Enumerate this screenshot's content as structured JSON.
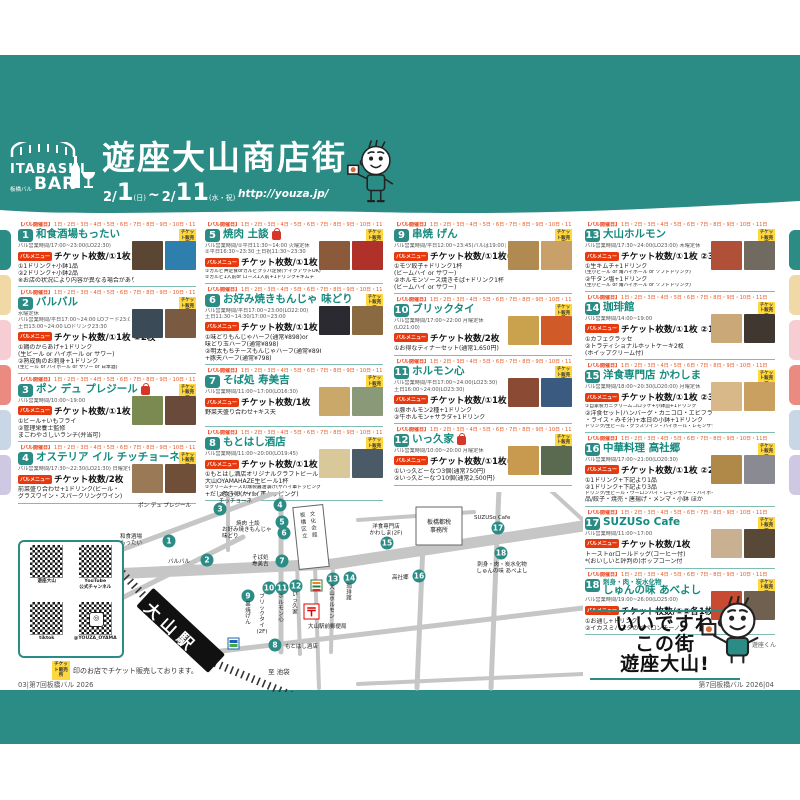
{
  "header": {
    "logo": {
      "top": "ITABASHI",
      "bottom": "BAR",
      "sub": "板橋バル"
    },
    "title": "遊座大山商店街",
    "date": {
      "m1": "2/",
      "d1": "1",
      "w1": "(日)",
      "tilde": "~",
      "m2": "2/",
      "d2": "11",
      "w2": "(水・祝)"
    },
    "url": "http://youza.jp/"
  },
  "badges": {
    "ticket_sale": "チケット販売所",
    "bar_menu": "バルメニュー",
    "open_days_prefix": "【バル開催日】",
    "open_days": "1日・2日・3日・4日・5日・6日・7日・8日・9日・10日・11日"
  },
  "entries": [
    {
      "num": "1",
      "col": 0,
      "name": "和食酒場もったい",
      "hours": [
        "バル営業時間/17:00~23:00(LO22:30)"
      ],
      "tickets": "チケット枚数/①1枚 ②2枚",
      "items": [
        "①1ドリンク+小鉢1品",
        "②2ドリンク+小鉢2品",
        "※お店の状況により内容が異なる場合があります"
      ],
      "photos": [
        "#5a4632",
        "#2f7fae"
      ]
    },
    {
      "num": "2",
      "col": 0,
      "name": "バルバル",
      "hours": [
        "水曜定休",
        "バル営業時間/平日17:00~24:00 LOフード23:00",
        "土日13:00~24:00 LOドリンク23:30"
      ],
      "tickets": "チケット枚数/①1枚 ②2枚",
      "items": [
        "①鶏のからあげ+1ドリンク",
        "(生ビール or ハイボール or サワー)",
        "②熟成魚のお刺身+1ドリンク",
        "(生ビール or ハイボール or サワー or 日本酒)"
      ],
      "photos": [
        "#3a4a56",
        "#7a5a40"
      ]
    },
    {
      "num": "3",
      "col": 0,
      "name": "ポン デュ プレジール",
      "bag": true,
      "hours": [
        "バル営業時間/10:00~19:00"
      ],
      "tickets": "チケット枚数/①1枚 ②2枚",
      "items": [
        "①ビール+いもフライ",
        "②管理栄養士監修",
        "まごわやさしいランチ(弁当可)"
      ],
      "photos": [
        "#7a8a50",
        "#6a4a3a"
      ]
    },
    {
      "num": "4",
      "col": 0,
      "name": "オステリア イル チッチョーネ",
      "hours": [
        "バル営業時間/17:30~22:30(LO21:30) 日曜定休"
      ],
      "tickets": "チケット枚数/2枚",
      "items": [
        "前菜盛り合わせ+1ドリンク(ビール・",
        "グラスワイン・スパークリングワイン)"
      ],
      "photos": [
        "#9a7a56",
        "#704f38"
      ]
    },
    {
      "num": "5",
      "col": 1,
      "name": "焼肉 土談",
      "bag": true,
      "hours": [
        "バル営業時間/①平日11:30~14:00 火曜定休",
        "②平日16:30~23:30 土日祝11:30~23:30"
      ],
      "tickets": "チケット枚数/①1枚 ②2枚",
      "items": [
        "①カルビ丼定食orカルビクッパ定食(テイクアウトOK)",
        "②カルビ1人前or ロース1人前+1ドリンク+キムチ"
      ],
      "photos": [
        "#8a5a3a",
        "#b0302a"
      ]
    },
    {
      "num": "6",
      "col": 1,
      "name": "お好み焼きもんじゃ 味どり",
      "hours": [
        "バル営業時間/平日17:00~23:00(LO22:00)",
        "土日11:30~14:30/17:00~23:00"
      ],
      "tickets": "チケット枚数/①1枚 ②2枚",
      "items": [
        "①味どりもんじゃハーフ(通常¥898)or",
        "味どり玉ハーフ(通常¥898)",
        "②明太もちチーズもんじゃハーフ(通常¥898)",
        "+豚天ハーフ(通常¥798)"
      ],
      "photos": [
        "#2a2a30",
        "#8a6a40"
      ]
    },
    {
      "num": "7",
      "col": 1,
      "name": "そば処 寿美吉",
      "hours": [
        "バル営業時間/11:00~17:00(LO16:30)"
      ],
      "tickets": "チケット枚数/1枚",
      "items": [
        "野菜天盛り合わせ+キス天"
      ],
      "photos": [
        "#caa86a",
        "#8a9a78"
      ]
    },
    {
      "num": "8",
      "col": 1,
      "name": "もとはし酒店",
      "hours": [
        "バル営業時間/11:00~20:00(LO19:45)"
      ],
      "tickets": "チケット枚数/①1枚 ②1枚",
      "items": [
        "①もとはし酒店オリジナルクラフトビール",
        "大山OYAMAHAZE生ビール1杯",
        "②クリームチーズの燻製醤油漬け(ヤバイ軍トッピング)",
        "+だし巻き卵(ヤバイ軍トッピング)"
      ],
      "photos": [
        "#d8c89a",
        "#4a5a66"
      ]
    },
    {
      "num": "9",
      "col": 2,
      "name": "串焼 げん",
      "hours": [
        "バル営業時間/平日12:00~23:45(バルは19:00まで)"
      ],
      "tickets": "チケット枚数/①1枚②2枚",
      "items": [
        "①モツ餃子+ドリンク1杯",
        "(ビームハイ or サワー)",
        "②ホルモンソース焼きそば+ドリンク1杯",
        "(ビームハイ or サワー)"
      ],
      "photos": [
        "#b08a50",
        "#caa06a"
      ]
    },
    {
      "num": "10",
      "col": 2,
      "name": "ブリックタイ",
      "hours": [
        "バル営業時間/17:00~22:00 月曜定休",
        "(LO21:00)"
      ],
      "tickets": "チケット枚数/2枚",
      "items": [
        "①お得なディナーセット(通常1,650円)"
      ],
      "photos": [
        "#caa24e",
        "#d05a28"
      ]
    },
    {
      "num": "11",
      "col": 2,
      "name": "ホルモン心",
      "hours": [
        "バル営業時間/平日17:00~24:00(LO23:30)",
        "土日16:00~24:00(LO23:30)"
      ],
      "tickets": "チケット枚数/①1枚 ②2枚",
      "items": [
        "①豚ホルモン2種+1ドリンク",
        "②牛ホルモン+サラダ+1ドリンク"
      ],
      "photos": [
        "#8a4a34",
        "#3a5a80"
      ]
    },
    {
      "num": "12",
      "col": 2,
      "name": "いっ久家",
      "bag": true,
      "hours": [
        "バル営業時間/10:00~20:00 月曜定休"
      ],
      "tickets": "チケット枚数/①1枚②3枚",
      "items": [
        "①いっ久どーなつ3個(通常750円)",
        "②いっ久どーなつ10個(通常2,500円)"
      ],
      "photos": [
        "#c89a50",
        "#5a6a50"
      ]
    },
    {
      "num": "13",
      "col": 3,
      "name": "大山ホルモン",
      "hours": [
        "バル営業時間/17:30~24:00(LO23:00) 木曜定休"
      ],
      "tickets": "チケット枚数/①1枚 ②3枚",
      "items": [
        "①生キムチ+1ドリンク",
        "(生小ビール or 角ハイボール or ソフトドリンク)",
        "②牛タン塩+1ドリンク",
        "(生小ビール or 角ハイボール or ソフトドリンク)"
      ],
      "photos": [
        "#b05038",
        "#706a60"
      ]
    },
    {
      "num": "14",
      "col": 3,
      "name": "珈琲館",
      "hours": [
        "バル営業時間/14:00~19:00"
      ],
      "tickets": "チケット枚数/①1枚 ②1枚",
      "items": [
        "①カフェクラッセ",
        "②トラディショナルホットケーキ2枚",
        "(ホイップクリーム付)"
      ],
      "photos": [
        "#caa878",
        "#403830"
      ]
    },
    {
      "num": "15",
      "col": 3,
      "name": "洋食専門店 かわしま",
      "hours": [
        "バル営業時間/18:00~20:30(LO20:00) 月曜定休"
      ],
      "tickets": "チケット枚数/①1枚 ②3枚",
      "items": [
        "①自家製カニクリームコロッケ+小鉢皿+1ドリンク",
        "②洋食セット(ハンバーグ・カニコロ・エビフライ",
        "・ライス・みそ汁)+本日の小鉢+1ドリンク",
        "ドリンク/生ビール・グラスワイン・ハイボール・レモンサワー・ウーロンハイ・ソフトドリンク"
      ],
      "photos": [
        "#d8b888",
        "#caa060"
      ]
    },
    {
      "num": "16",
      "col": 3,
      "name": "中華料理 高社郷",
      "hours": [
        "バル営業時間/17:00~21:00(LO20:30)"
      ],
      "tickets": "チケット枚数/①1枚 ②2枚",
      "items": [
        "①1ドリンク+下記より1品",
        "②1ドリンク+下記より3品",
        "ドリンク/生ビール・ウーロンハイ・レモンサワー・ハイボール ほか",
        "品/餃子・焼売・唐揚げ・メンマ・小鉢 ほか"
      ],
      "photos": [
        "#b08848",
        "#8a8a92"
      ]
    },
    {
      "num": "17",
      "col": 3,
      "name": "SUZUSo Cafe",
      "hours": [
        "バル営業時間/11:00~17:00"
      ],
      "tickets": "チケット枚数/1枚",
      "items": [
        "トーストorロールドッグ(コーヒー付)",
        "*(おいしいと評判の)ポップコーン付"
      ],
      "photos": [
        "#c8b090",
        "#584838"
      ]
    },
    {
      "num": "18",
      "col": 3,
      "name_small": "刺身・肉・炭水化物",
      "name": "しゅんの味 あべよし",
      "hours": [
        "バル営業時間/19:00~26:00(LO25:00)"
      ],
      "tickets": "チケット枚数/①②各1枚",
      "items": [
        "①お通し+ドリンク",
        "②イカスミパスタのペペロンチーノ"
      ],
      "photos": [
        "#c84a30",
        "#706050"
      ]
    }
  ],
  "map": {
    "station": "大山駅",
    "to_ikebukuro": "至 池袋",
    "post_mark": "〒",
    "post_office": "大山駅前郵便局",
    "culture_hall": [
      "板橋区立",
      "文化会館"
    ],
    "tax_office": [
      "板橋都税",
      "事務所"
    ],
    "pins": [
      {
        "n": "1",
        "x": 51,
        "y": 49,
        "v": false,
        "lines": [
          "和食酒場",
          "もったい"
        ],
        "lx": 2,
        "ly": 46,
        "anchor": "start"
      },
      {
        "n": "2",
        "x": 89,
        "y": 68,
        "v": false,
        "lines": [
          "バルバル"
        ],
        "lx": 50,
        "ly": 71,
        "anchor": "start"
      },
      {
        "n": "3",
        "x": 102,
        "y": 17,
        "v": false,
        "lines": [
          "ポン デュ プレジール"
        ],
        "lx": 20,
        "ly": 15,
        "anchor": "start"
      },
      {
        "n": "4",
        "x": 162,
        "y": 13,
        "v": false,
        "lines": [
          "オステリアイル",
          "チッチョーネ"
        ],
        "lx": 101,
        "ly": 4,
        "anchor": "start"
      },
      {
        "n": "5",
        "x": 164,
        "y": 30,
        "v": false,
        "lines": [
          "焼肉 土談"
        ],
        "lx": 118,
        "ly": 33,
        "anchor": "start"
      },
      {
        "n": "6",
        "x": 166,
        "y": 41,
        "v": false,
        "lines": [
          "お好み焼きもんじゃ",
          "味どり"
        ],
        "lx": 104,
        "ly": 39,
        "anchor": "start"
      },
      {
        "n": "7",
        "x": 164,
        "y": 69,
        "v": false,
        "lines": [
          "そば処",
          "寿美吉"
        ],
        "lx": 134,
        "ly": 67,
        "anchor": "start"
      },
      {
        "n": "8",
        "x": 157,
        "y": 153,
        "v": false,
        "lines": [
          "もとはし酒店"
        ],
        "lx": 167,
        "ly": 156,
        "anchor": "start"
      },
      {
        "n": "9",
        "x": 130,
        "y": 104,
        "v": true,
        "vtext": "串焼げん",
        "lx": 130,
        "ly": 114
      },
      {
        "n": "10",
        "x": 151,
        "y": 96,
        "v": true,
        "vtext": "ブリックタイ(2F)",
        "lx": 144,
        "ly": 106
      },
      {
        "n": "11",
        "x": 164,
        "y": 96,
        "v": true,
        "vtext": "ホルモン心",
        "lx": 163,
        "ly": 106
      },
      {
        "n": "12",
        "x": 178,
        "y": 94,
        "v": true,
        "vtext": "いっ久家",
        "lx": 177,
        "ly": 104
      },
      {
        "n": "13",
        "x": 215,
        "y": 87,
        "v": true,
        "vtext": "大山ホルモン",
        "lx": 214,
        "ly": 97
      },
      {
        "n": "14",
        "x": 232,
        "y": 86,
        "v": true,
        "vtext": "珈琲館",
        "lx": 231,
        "ly": 96
      },
      {
        "n": "15",
        "x": 269,
        "y": 51,
        "v": false,
        "lines": [
          "洋食専門店",
          "かわしま(2F)"
        ],
        "lx": 268,
        "ly": 36,
        "anchor": "middle"
      },
      {
        "n": "16",
        "x": 301,
        "y": 84,
        "v": false,
        "lines": [
          "高社郷"
        ],
        "lx": 274,
        "ly": 87,
        "anchor": "start"
      },
      {
        "n": "17",
        "x": 380,
        "y": 36,
        "v": false,
        "lines": [
          "SUZUSo Cafe"
        ],
        "lx": 356,
        "ly": 27,
        "anchor": "start"
      },
      {
        "n": "18",
        "x": 383,
        "y": 61,
        "v": false,
        "lines": [
          "刺身・肉・炭水化物",
          "しゅんの味 あべよし"
        ],
        "lx": 384,
        "ly": 74,
        "anchor": "middle"
      }
    ]
  },
  "qr": {
    "items": [
      {
        "label": "遊座大山"
      },
      {
        "label": "YouTube\n公式チャンネル"
      },
      {
        "label": "tiktok"
      },
      {
        "label": "@YOUZA_OYAMA",
        "icon": "instagram"
      }
    ]
  },
  "footnote": {
    "text": "印のお店でチケット販売しております。"
  },
  "footers": {
    "left": "03|第7回板橋バル 2026",
    "right": "第7回板橋バル 2026|04"
  },
  "slogan": {
    "l1": "いいですね",
    "l2": "この街",
    "l3": "遊座大山!",
    "mascot": "遊座くん"
  },
  "colors": {
    "teal": "#2b8b85",
    "accent_red": "#e8380d",
    "badge_yellow": "#ffd83f",
    "side_tabs": [
      "#2b8b85",
      "#f0d9a6",
      "#f5cdd3",
      "#ea8a80",
      "#c9d6e6",
      "#cfc8e2"
    ]
  }
}
